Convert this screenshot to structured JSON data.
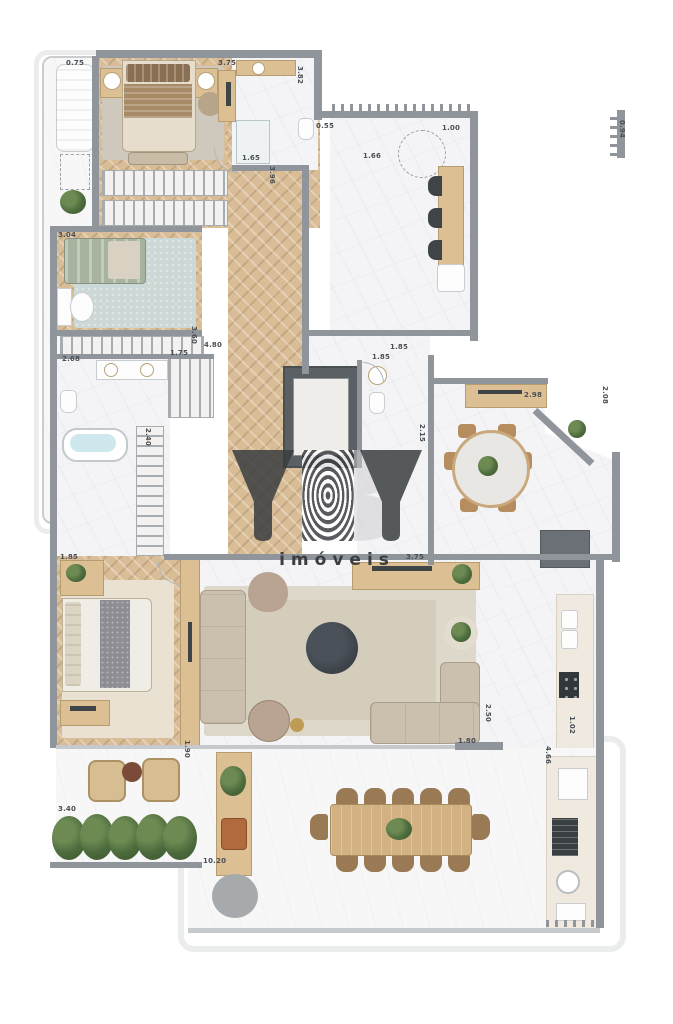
{
  "watermark": {
    "brand": "YBY",
    "tagline": "imóveis"
  },
  "plan": {
    "dimension_labels": [
      {
        "text": "0.75",
        "x": 66,
        "y": 59,
        "vertical": false
      },
      {
        "text": "3.75",
        "x": 218,
        "y": 59,
        "vertical": false
      },
      {
        "text": "3.82",
        "x": 296,
        "y": 66,
        "vertical": true
      },
      {
        "text": "0.55",
        "x": 316,
        "y": 122,
        "vertical": false
      },
      {
        "text": "1.66",
        "x": 363,
        "y": 152,
        "vertical": false
      },
      {
        "text": "1.00",
        "x": 442,
        "y": 124,
        "vertical": false
      },
      {
        "text": "0.94",
        "x": 618,
        "y": 120,
        "vertical": true
      },
      {
        "text": "1.65",
        "x": 242,
        "y": 154,
        "vertical": false
      },
      {
        "text": "3.96",
        "x": 268,
        "y": 166,
        "vertical": true
      },
      {
        "text": "3.04",
        "x": 58,
        "y": 231,
        "vertical": false
      },
      {
        "text": "3.60",
        "x": 190,
        "y": 326,
        "vertical": true
      },
      {
        "text": "4.80",
        "x": 204,
        "y": 341,
        "vertical": false
      },
      {
        "text": "2.68",
        "x": 62,
        "y": 355,
        "vertical": false
      },
      {
        "text": "1.75",
        "x": 170,
        "y": 349,
        "vertical": false
      },
      {
        "text": "2.40",
        "x": 144,
        "y": 428,
        "vertical": true
      },
      {
        "text": "1.85",
        "x": 372,
        "y": 353,
        "vertical": false
      },
      {
        "text": "1.85",
        "x": 390,
        "y": 343,
        "vertical": false
      },
      {
        "text": "2.15",
        "x": 418,
        "y": 424,
        "vertical": true
      },
      {
        "text": "2.98",
        "x": 524,
        "y": 391,
        "vertical": false
      },
      {
        "text": "2.08",
        "x": 601,
        "y": 386,
        "vertical": true
      },
      {
        "text": "3.75",
        "x": 406,
        "y": 553,
        "vertical": false
      },
      {
        "text": "1.85",
        "x": 60,
        "y": 553,
        "vertical": false
      },
      {
        "text": "1.90",
        "x": 183,
        "y": 740,
        "vertical": true
      },
      {
        "text": "2.50",
        "x": 484,
        "y": 704,
        "vertical": true
      },
      {
        "text": "1.80",
        "x": 458,
        "y": 737,
        "vertical": false
      },
      {
        "text": "1.02",
        "x": 568,
        "y": 716,
        "vertical": true
      },
      {
        "text": "4.66",
        "x": 544,
        "y": 746,
        "vertical": true
      },
      {
        "text": "3.40",
        "x": 58,
        "y": 805,
        "vertical": false
      },
      {
        "text": "10.20",
        "x": 203,
        "y": 857,
        "vertical": false
      }
    ],
    "colors": {
      "wall": "#8f959b",
      "wood_floor": "#d8bd96",
      "marble": "#f4f4f6",
      "furniture_wood": "#dcc094",
      "dark_fixture": "#3f4447",
      "plant": "#4c6b3c",
      "tub_water": "#cfe8ee",
      "watermark": "#3b3e41"
    }
  }
}
